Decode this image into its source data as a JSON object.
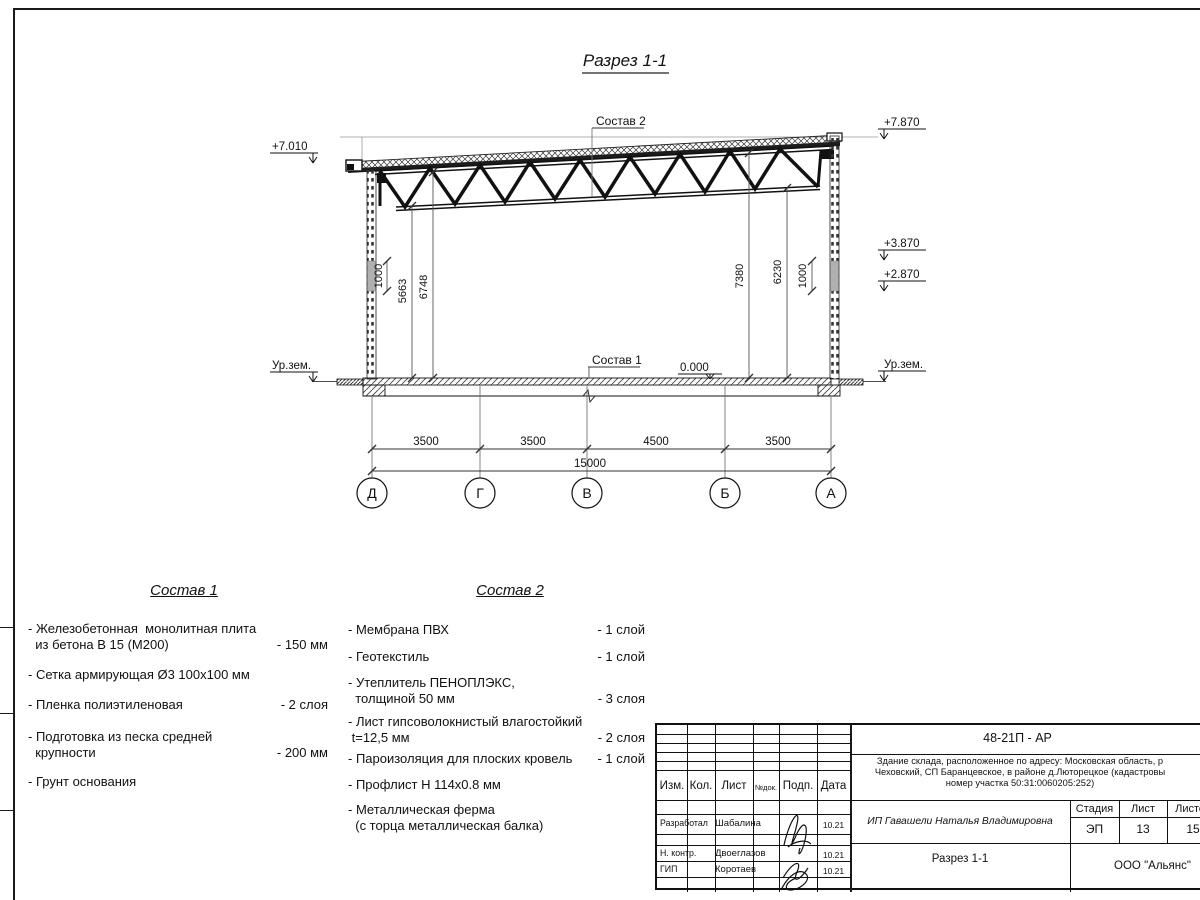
{
  "sheet": {
    "drawing_title": "Разрез 1-1",
    "leader_sostav1": "Состав 1",
    "leader_sostav2": "Состав 2",
    "elevations": {
      "left_top": "+7.010",
      "right_top": "+7.870",
      "right_upper": "+3.870",
      "right_lower": "+2.870",
      "zero": "0.000",
      "ground_left": "Ур.зем.",
      "ground_right": "Ур.зем."
    },
    "height_dims": {
      "left_small": "1000",
      "left_inner": "5663",
      "left_outer": "6748",
      "right_outer": "7380",
      "right_inner": "6230",
      "right_small": "1000"
    },
    "span_dims": [
      "3500",
      "3500",
      "4500",
      "3500"
    ],
    "total_span": "15000",
    "axes": [
      "Д",
      "Г",
      "В",
      "Б",
      "А"
    ]
  },
  "sostav1": {
    "title": "Состав 1",
    "items": [
      {
        "name": "- Железобетонная  монолитная плита\n  из бетона В 15 (М200)",
        "value": "- 150 мм"
      },
      {
        "name": "- Сетка армирующая Ø3 100х100 мм",
        "value": ""
      },
      {
        "name": "- Пленка полиэтиленовая",
        "value": "-  2 слоя"
      },
      {
        "name": "- Подготовка из песка средней\n  крупности",
        "value": "- 200 мм"
      },
      {
        "name": "- Грунт основания",
        "value": ""
      }
    ]
  },
  "sostav2": {
    "title": "Состав 2",
    "items": [
      {
        "name": "- Мембрана ПВХ",
        "value": "- 1 слой"
      },
      {
        "name": "- Геотекстиль",
        "value": "- 1 слой"
      },
      {
        "name": "- Утеплитель ПЕНОПЛЭКС,\n  толщиной 50 мм",
        "value": "- 3 слоя"
      },
      {
        "name": "- Лист гипсоволокнистый влагостойкий\n t=12,5 мм",
        "value": "- 2 слоя"
      },
      {
        "name": "- Пароизоляция для плоских кровель",
        "value": "- 1 слой"
      },
      {
        "name": "- Профлист Н 114х0.8 мм",
        "value": ""
      },
      {
        "name": "- Металлическая ферма\n  (с торца металлическая балка)",
        "value": ""
      }
    ]
  },
  "titleblock": {
    "code": "48-21П - АР",
    "project_line1": "Здание склада, расположенное по адресу: Московская область, р",
    "project_line2": "Чеховский, СП Баранцевское, в районе д.Люторецкое  (кадастровы",
    "project_line3": "номер участка 50:31:0060205:252)",
    "client": "ИП Гавашели Наталья Владимировна",
    "stage_label": "Стадия",
    "sheet_label": "Лист",
    "sheets_label": "Листов",
    "stage": "ЭП",
    "sheet_no": "13",
    "sheets_total": "15",
    "section_title": "Разрез 1-1",
    "company": "ООО \"Альянс\"",
    "cols": {
      "izm": "Изм.",
      "kol": "Кол.",
      "list": "Лист",
      "ndok": "№док.",
      "podp": "Подп.",
      "data": "Дата"
    },
    "rows": [
      {
        "role": "Разработал",
        "name": "Шабалина",
        "date": "10.21"
      },
      {
        "role": "Н. контр.",
        "name": "Двоеглазов",
        "date": "10.21"
      },
      {
        "role": "ГИП",
        "name": "Коротаев",
        "date": "10.21"
      }
    ]
  }
}
